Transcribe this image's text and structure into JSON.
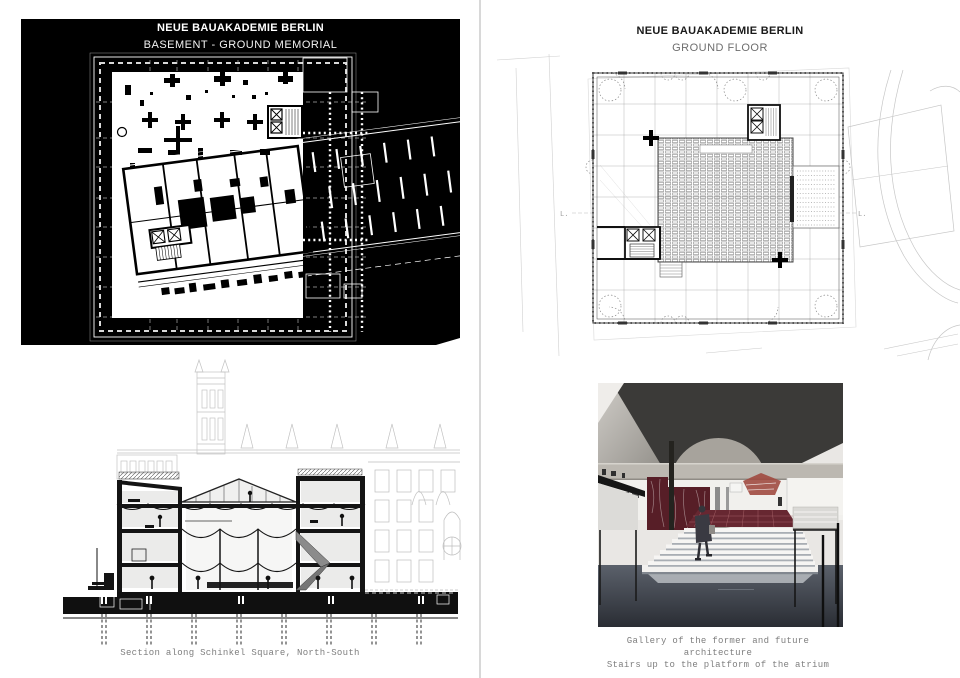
{
  "page": {
    "background": "#ffffff",
    "divider_color": "#d8d8d8"
  },
  "basement_panel": {
    "title": "NEUE BAUAKADEMIE BERLIN",
    "subtitle": "BASEMENT - GROUND MEMORIAL",
    "background": "#000000",
    "line_color": "#ffffff"
  },
  "ground_floor_panel": {
    "title": "NEUE BAUAKADEMIE BERLIN",
    "subtitle": "GROUND FLOOR",
    "line_color": "#4a4a4a",
    "context_line_color": "#c6c6c6",
    "label_left": "L.",
    "label_right": "L."
  },
  "section_panel": {
    "caption": "Section along Schinkel Square, North-South"
  },
  "render_panel": {
    "caption_line1": "Gallery of the former and future architecture",
    "caption_line2": "Stairs up to the platform of the atrium",
    "colors": {
      "ceiling": "#3b3a38",
      "concrete_beam": "#bcb8b1",
      "arch": "#a7a39c",
      "marble_red": "#571e27",
      "roof_red": "#a04a40",
      "platform_red": "#672731",
      "floor_dark": "#2c2f36",
      "floor_light": "#5b616b"
    }
  }
}
